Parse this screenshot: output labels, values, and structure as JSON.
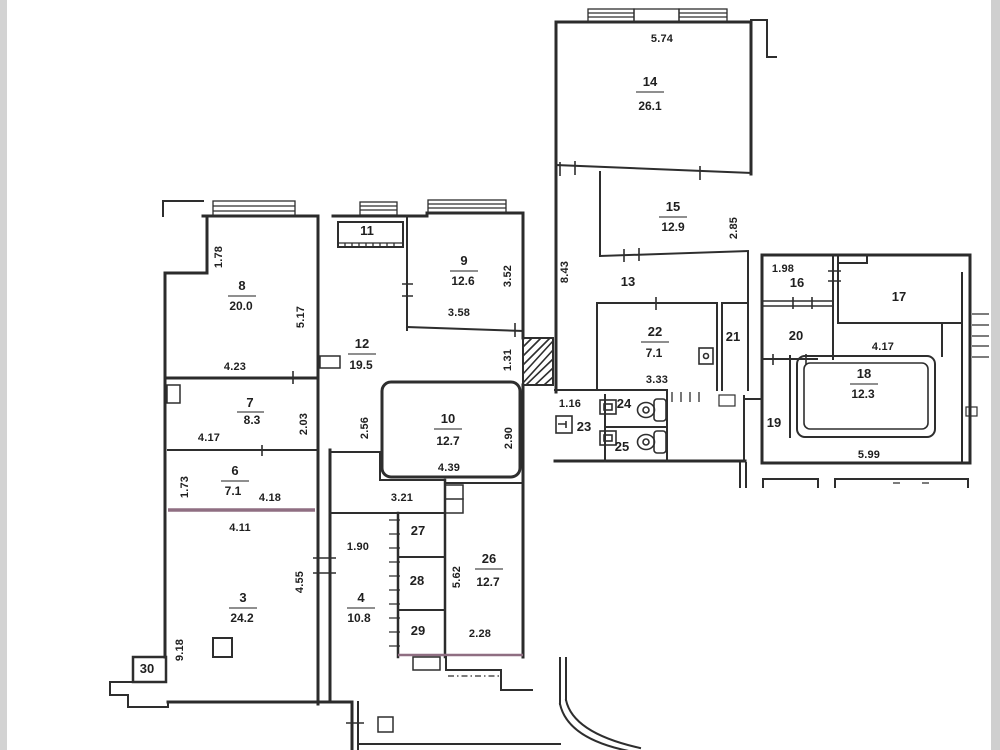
{
  "palette": {
    "paper": "#ffffff",
    "ink": "#2b2b2b",
    "tint_wall": "#8f6e82",
    "scan_edge": "#d3d3d3"
  },
  "rooms": {
    "r3": {
      "n": "3",
      "area": "24.2"
    },
    "r4": {
      "n": "4",
      "area": "10.8"
    },
    "r6": {
      "n": "6",
      "area": "7.1"
    },
    "r7": {
      "n": "7",
      "area": "8.3"
    },
    "r8": {
      "n": "8",
      "area": "20.0"
    },
    "r9": {
      "n": "9",
      "area": "12.6"
    },
    "r10": {
      "n": "10",
      "area": "12.7"
    },
    "r11": {
      "n": "11"
    },
    "r12": {
      "n": "12",
      "area": "19.5"
    },
    "r13": {
      "n": "13"
    },
    "r14": {
      "n": "14",
      "area": "26.1"
    },
    "r15": {
      "n": "15",
      "area": "12.9"
    },
    "r16": {
      "n": "16"
    },
    "r17": {
      "n": "17"
    },
    "r18": {
      "n": "18",
      "area": "12.3"
    },
    "r19": {
      "n": "19"
    },
    "r20": {
      "n": "20"
    },
    "r21": {
      "n": "21"
    },
    "r22": {
      "n": "22",
      "area": "7.1"
    },
    "r23": {
      "n": "23"
    },
    "r24": {
      "n": "24"
    },
    "r25": {
      "n": "25"
    },
    "r26": {
      "n": "26",
      "area": "12.7"
    },
    "r27": {
      "n": "27"
    },
    "r28": {
      "n": "28"
    },
    "r29": {
      "n": "29"
    },
    "r30": {
      "n": "30"
    }
  },
  "dims": {
    "w14_top": "5.74",
    "h15_right": "2.85",
    "h13_left": "8.43",
    "w16_top": "1.98",
    "w18_top": "4.17",
    "w18_bottom": "5.99",
    "w22_bottom": "3.33",
    "w23_top": "1.16",
    "h8_left": "1.78",
    "h8_right": "5.17",
    "w8_bottom": "4.23",
    "w7_bottom": "4.17",
    "h7_right": "2.03",
    "h6_left": "1.73",
    "w6_right": "4.18",
    "w6_bottom": "4.11",
    "h3_left": "9.18",
    "h3_right": "4.55",
    "w4_top": "1.90",
    "h9_right": "3.52",
    "w9_bottom": "3.58",
    "h10_left": "2.56",
    "h10_right": "2.90",
    "w10_bottom": "4.39",
    "h_shaft": "1.31",
    "w27_top": "3.21",
    "h26_left": "5.62",
    "w26_bottom": "2.28"
  }
}
